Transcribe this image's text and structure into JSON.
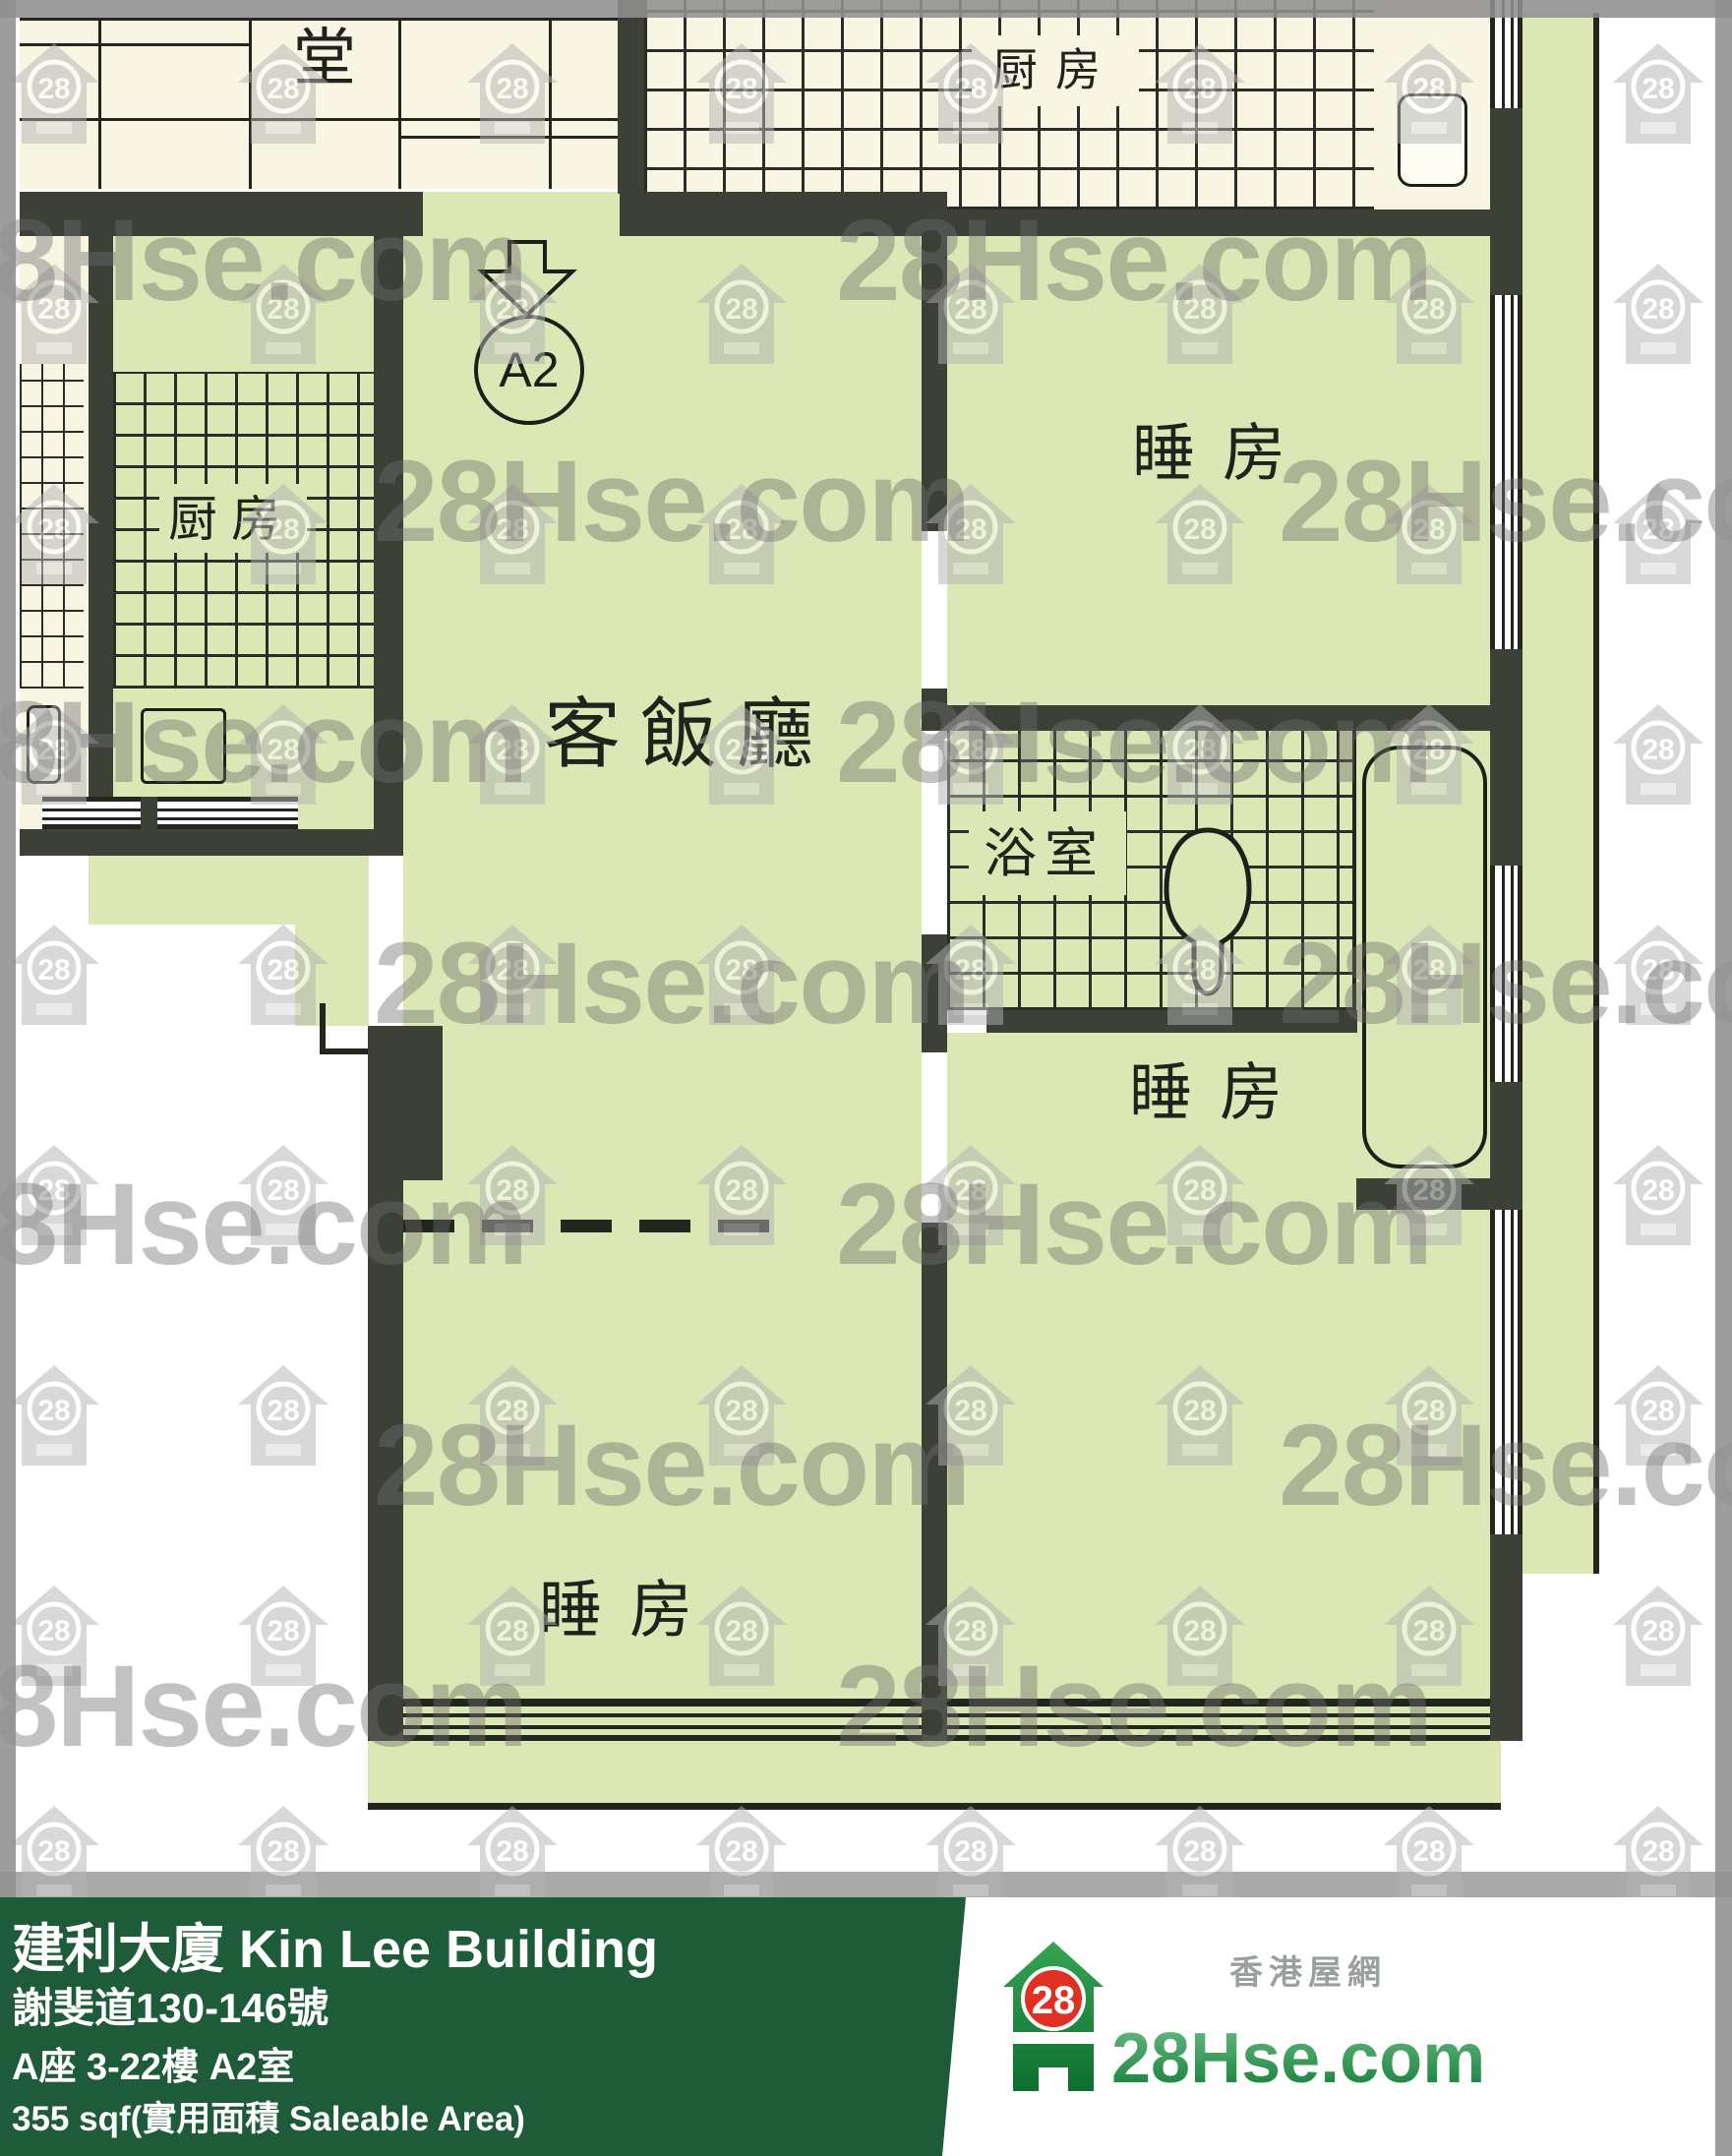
{
  "plan": {
    "marker": {
      "label": "A2"
    },
    "rooms": {
      "hall": {
        "label": "堂"
      },
      "neighbor_kitchen": {
        "label": "厨房"
      },
      "kitchen": {
        "label": "厨房"
      },
      "living_dining": {
        "label": "客飯廳"
      },
      "bathroom": {
        "label": "浴室"
      },
      "bedroom_top": {
        "label": "睡房"
      },
      "bedroom_bottom_right": {
        "label": "睡房"
      },
      "bedroom_bottom_left": {
        "label": "睡房"
      }
    }
  },
  "watermark": {
    "brand": "28Hse.com",
    "badge": "28"
  },
  "footer": {
    "building_title": "建利大廈 Kin Lee Building",
    "address": "謝斐道130-146號",
    "unit": "A座 3-22樓 A2室",
    "area": "355 sqf(實用面積 Saleable Area)"
  },
  "logo": {
    "badge": "28",
    "brand": "28Hse.com",
    "tagline": "香港屋網"
  },
  "colors": {
    "room_green": "#dbe7b4",
    "plan_cream": "#f8f5e3",
    "wall_dark": "#3c4036",
    "footer_green": "#1e5b38",
    "logo_red": "#e03022",
    "logo_green": "#15803d",
    "watermark_gray": "#8f8f8f"
  }
}
